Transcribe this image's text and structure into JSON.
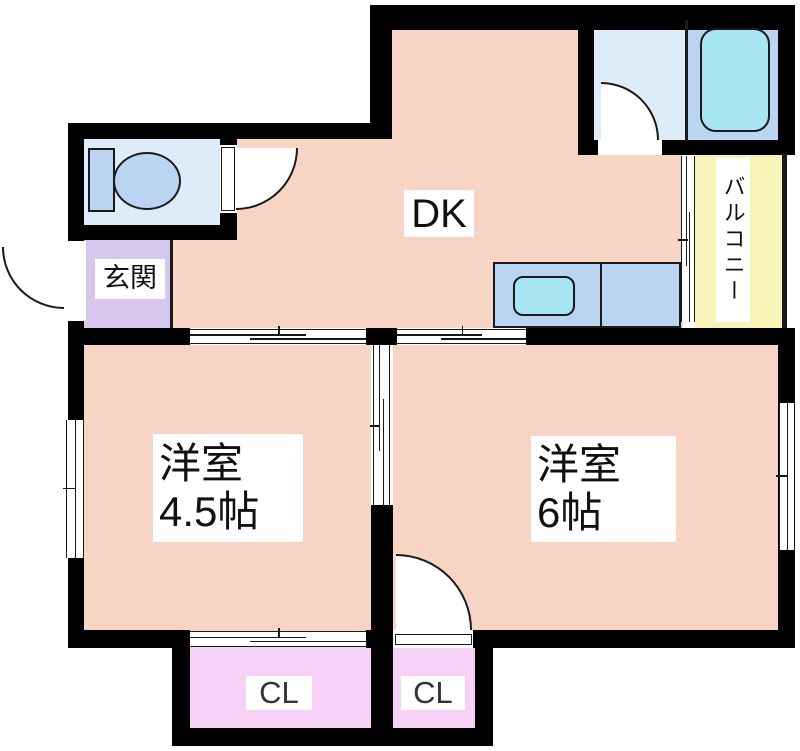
{
  "plan": {
    "type": "apartment-floor-plan",
    "rooms": {
      "dining_kitchen": {
        "label": "DK"
      },
      "entrance": {
        "label": "玄関"
      },
      "balcony": {
        "label": "バルコニー"
      },
      "western_room_left": {
        "name": "洋室",
        "size": "4.5帖"
      },
      "western_room_right": {
        "name": "洋室",
        "size": "6帖"
      },
      "closet_left": {
        "label": "CL"
      },
      "closet_right": {
        "label": "CL"
      }
    },
    "fixtures": [
      "toilet",
      "bathtub",
      "kitchen-sink"
    ],
    "colors": {
      "wall": "#000000",
      "floor_main": "#f8d4c5",
      "water_room": "#ddecf8",
      "bath_room": "#bad4f1",
      "fixture_fill": "#a8e6f3",
      "balcony": "#f7f3b6",
      "entrance": "#d6c7ee",
      "closet": "#f8d1f6",
      "label_bg": "#ffffff",
      "line": "#1a1a1a"
    }
  }
}
